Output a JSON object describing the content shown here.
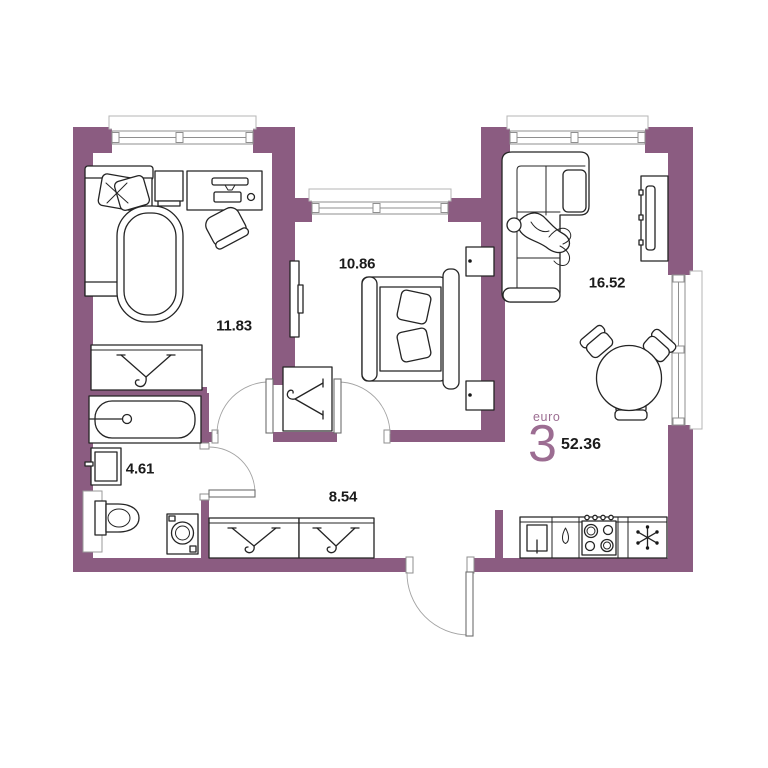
{
  "plan": {
    "logo": {
      "brand": "euro",
      "number": "3",
      "total_area": "52.36"
    },
    "rooms": [
      {
        "id": "bedroom-1",
        "label": "11.83"
      },
      {
        "id": "bedroom-2",
        "label": "10.86"
      },
      {
        "id": "living-kitchen",
        "label": "16.52"
      },
      {
        "id": "bathroom",
        "label": "4.61"
      },
      {
        "id": "hallway",
        "label": "8.54"
      }
    ],
    "furniture": {
      "bedroom-1": [
        "single-bed",
        "pillow",
        "duvet",
        "tv-stand",
        "desk",
        "desk-chair",
        "wardrobe-hanger-icon"
      ],
      "bedroom-2": [
        "double-bed",
        "pillow",
        "nightstand",
        "nightstand",
        "tv-panel",
        "wardrobe-hanger-icon"
      ],
      "living-kitchen": [
        "corner-sofa",
        "person-lying",
        "tv-console",
        "round-dining-table",
        "dining-chair",
        "dining-chair",
        "dining-chair",
        "kitchen-sink-icon",
        "teardrop-handle-icon",
        "hob-burners-icon",
        "fridge-snowflake-icon"
      ],
      "bathroom": [
        "bathtub",
        "washbasin",
        "toilet",
        "washing-machine",
        "shaft"
      ],
      "hallway": [
        "wardrobe-hanger-icon",
        "wardrobe-hanger-icon",
        "entrance-door"
      ]
    },
    "colors": {
      "wall": "#8b5c81",
      "logo": "#9c6d92",
      "line": "#242424",
      "frame": "#8f8f8f",
      "background": "#ffffff"
    }
  }
}
